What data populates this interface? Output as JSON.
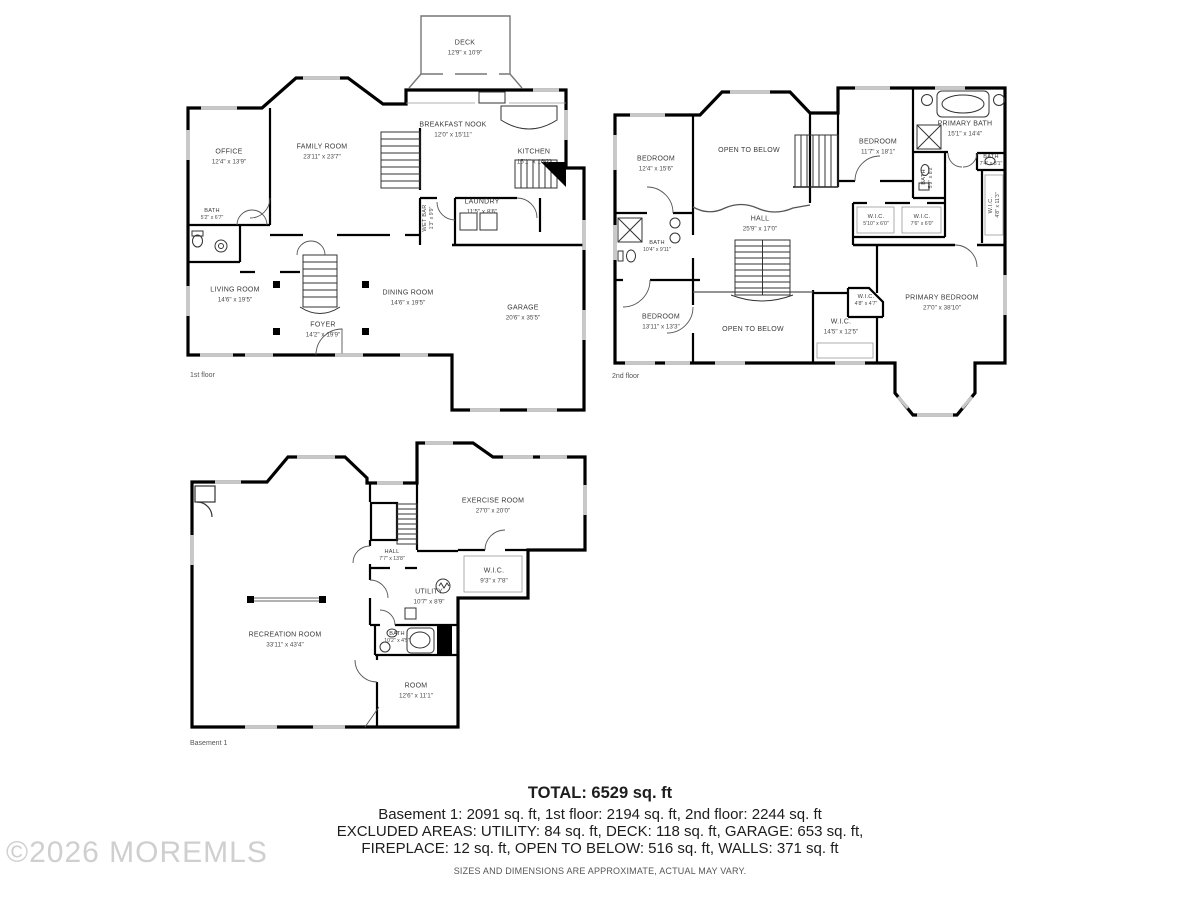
{
  "watermark": {
    "text": "©2026 MOREMLS",
    "color": "#cfcfcf"
  },
  "summary": {
    "total": "TOTAL: 6529 sq. ft",
    "line1": "Basement 1: 2091 sq. ft, 1st floor: 2194 sq. ft, 2nd floor: 2244 sq. ft",
    "line2": "EXCLUDED AREAS: UTILITY: 84 sq. ft, DECK: 118 sq. ft, GARAGE: 653 sq. ft,",
    "line3": "FIREPLACE: 12 sq. ft, OPEN TO BELOW: 516 sq. ft, WALLS: 371 sq. ft",
    "disclaimer": "SIZES AND DIMENSIONS ARE APPROXIMATE, ACTUAL MAY VARY."
  },
  "floors": [
    {
      "label": "1st floor",
      "rooms": [
        {
          "name": "DECK",
          "dims": "12'9\" x 10'9\""
        },
        {
          "name": "OFFICE",
          "dims": "12'4\" x 13'9\""
        },
        {
          "name": "FAMILY ROOM",
          "dims": "23'11\" x 23'7\""
        },
        {
          "name": "BREAKFAST NOOK",
          "dims": "12'0\" x 15'11\""
        },
        {
          "name": "KITCHEN",
          "dims": "15'1\" x 16'3\""
        },
        {
          "name": "BATH",
          "dims": "5'2\" x 6'7\""
        },
        {
          "name": "WET BAR",
          "dims": "1'3\" x 9'9\""
        },
        {
          "name": "LAUNDRY",
          "dims": "11'5\" x 8'6\""
        },
        {
          "name": "LIVING ROOM",
          "dims": "14'6\" x 19'5\""
        },
        {
          "name": "DINING ROOM",
          "dims": "14'6\" x 19'5\""
        },
        {
          "name": "FOYER",
          "dims": "14'2\" x 19'9\""
        },
        {
          "name": "GARAGE",
          "dims": "20'6\" x 35'5\""
        }
      ]
    },
    {
      "label": "2nd floor",
      "rooms": [
        {
          "name": "BEDROOM",
          "dims": "12'4\" x 15'6\""
        },
        {
          "name": "OPEN TO BELOW"
        },
        {
          "name": "HALL",
          "dims": "25'9\" x 17'0\""
        },
        {
          "name": "BATH",
          "dims": "10'4\" x 9'11\""
        },
        {
          "name": "BEDROOM",
          "dims": "11'7\" x 18'1\""
        },
        {
          "name": "PRIMARY BATH",
          "dims": "15'1\" x 14'4\""
        },
        {
          "name": "BATH",
          "dims": "7'4\" x 3'1\""
        },
        {
          "name": "BATH",
          "dims": "5'9\" x 8'2\""
        },
        {
          "name": "W.I.C.",
          "dims": "5'10\" x 6'0\""
        },
        {
          "name": "W.I.C.",
          "dims": "7'6\" x 6'0\""
        },
        {
          "name": "W.I.C.",
          "dims": "4'8\" x 11'3\""
        },
        {
          "name": "BEDROOM",
          "dims": "13'11\" x 13'3\""
        },
        {
          "name": "OPEN TO BELOW"
        },
        {
          "name": "W.I.C.",
          "dims": "14'5\" x 12'5\""
        },
        {
          "name": "W.I.C.",
          "dims": "4'8\" x 4'7\""
        },
        {
          "name": "PRIMARY BEDROOM",
          "dims": "27'0\" x 38'10\""
        }
      ]
    },
    {
      "label": "Basement 1",
      "rooms": [
        {
          "name": "EXERCISE ROOM",
          "dims": "27'0\" x 20'0\""
        },
        {
          "name": "HALL",
          "dims": "7'7\" x 13'8\""
        },
        {
          "name": "W.I.C.",
          "dims": "9'3\" x 7'8\""
        },
        {
          "name": "UTILITY",
          "dims": "10'7\" x 8'9\""
        },
        {
          "name": "RECREATION ROOM",
          "dims": "33'11\" x 43'4\""
        },
        {
          "name": "BATH",
          "dims": "10'2\" x 4'5\""
        },
        {
          "name": "ROOM",
          "dims": "12'6\" x 11'1\""
        }
      ]
    }
  ]
}
